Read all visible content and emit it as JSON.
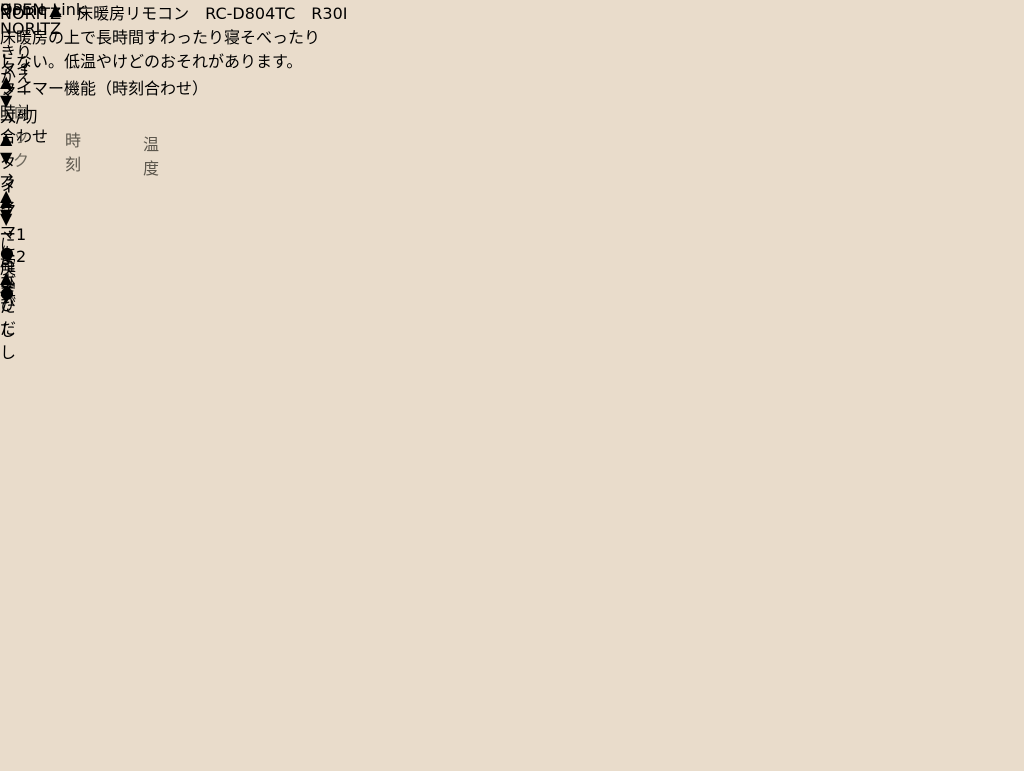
{
  "watermark": {
    "text": "Home Link"
  },
  "symbols": {
    "up": "▲",
    "down": "▼",
    "arrow": "→",
    "bullet": "●"
  },
  "kitchen_remote": {
    "brand": "NORITZ",
    "open_label": "OPEN ▲"
  },
  "floor_remote": {
    "display_digit": "9",
    "lock_label": "ロック",
    "switch_label": "きりかえ",
    "timer_power_line1": "タイマー",
    "timer_power_line2": "入/切",
    "group_label": "タイマー機能（時刻合わせ）",
    "timer1_line1": "タイマー1",
    "timer1_line2": "よびだし",
    "timer2_line1": "タイマー2",
    "timer2_line2": "よびだし",
    "clock_set_line1": "時計",
    "clock_set_line2": "合わせ",
    "clock_label": "時刻",
    "back_label": "に戻す",
    "confirm_label": "確定",
    "temp_label": "温度"
  },
  "flap": {
    "header": "NORITZ　床暖房リモコン　RC-D804TC　R30I",
    "warning_line1": "床暖房の上で長時間すわったり寝そべったり",
    "warning_line2": "しない。低温やけどのおそれがあります。"
  }
}
